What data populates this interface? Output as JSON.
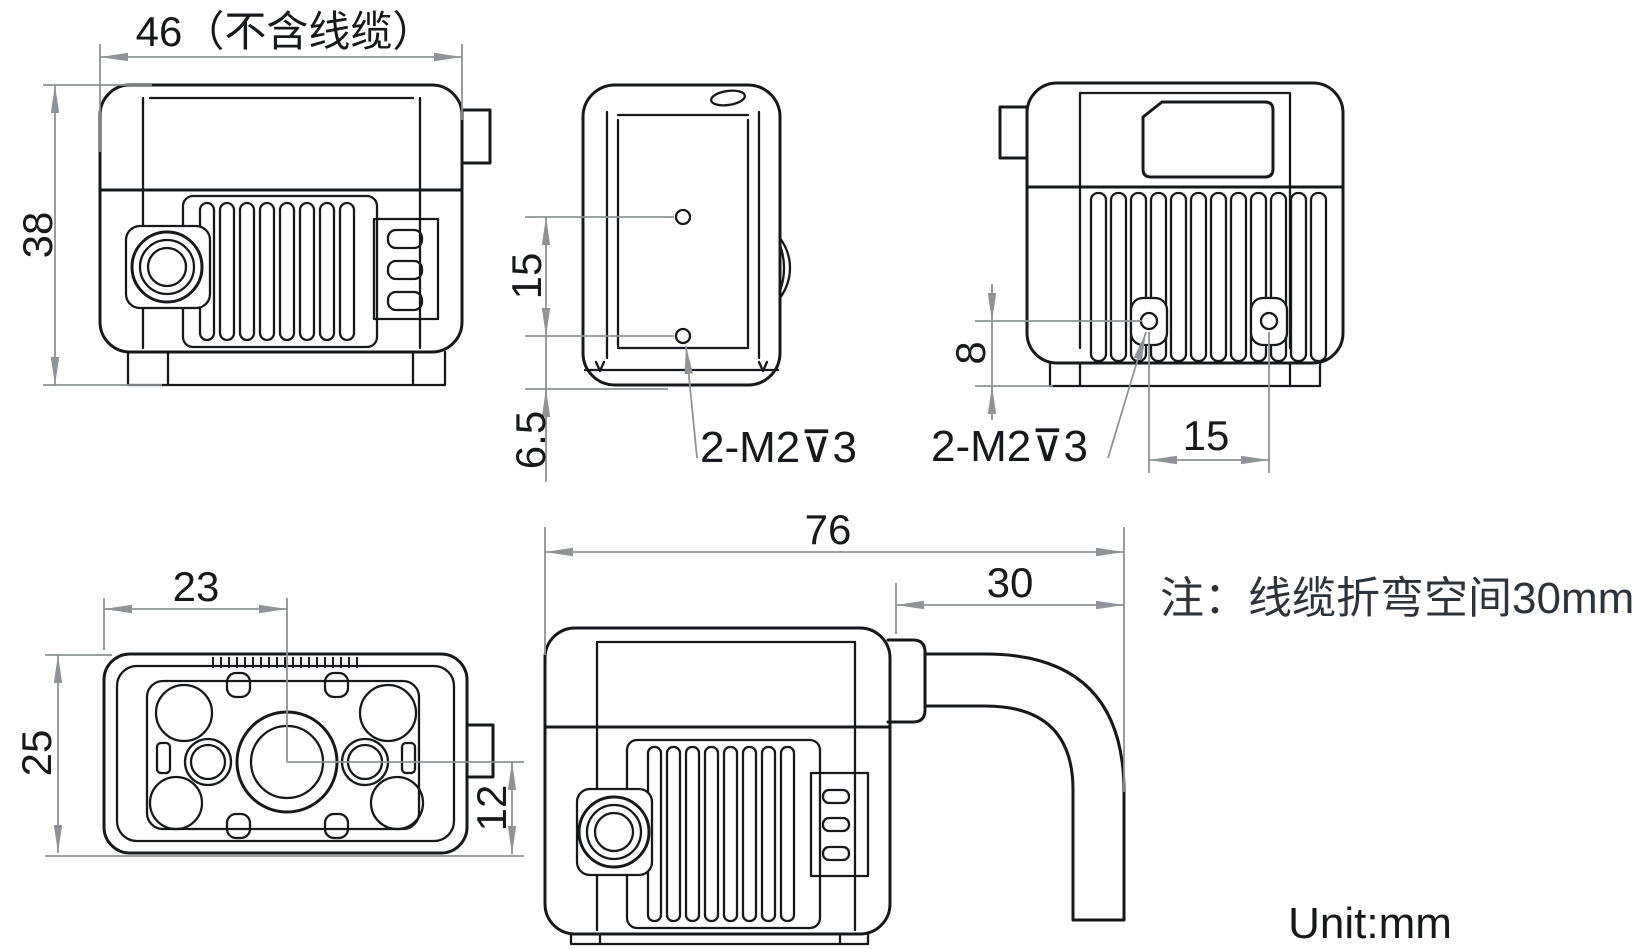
{
  "drawing": {
    "note": "注：线缆折弯空间30mm",
    "unit_label": "Unit:mm",
    "views": {
      "side": {
        "width": "46（不含线缆）",
        "height": "38"
      },
      "bottom": {
        "hole_spacing": "15",
        "hole_to_edge": "6.5",
        "thread": "2-M2⊽3"
      },
      "rear": {
        "hole_to_base": "8",
        "hole_spacing": "15",
        "thread": "2-M2⊽3"
      },
      "front": {
        "lens_center_x": "23",
        "height": "25",
        "lens_center_to_base": "12"
      },
      "side_cable": {
        "total_width": "76",
        "bend_space": "30"
      }
    }
  }
}
